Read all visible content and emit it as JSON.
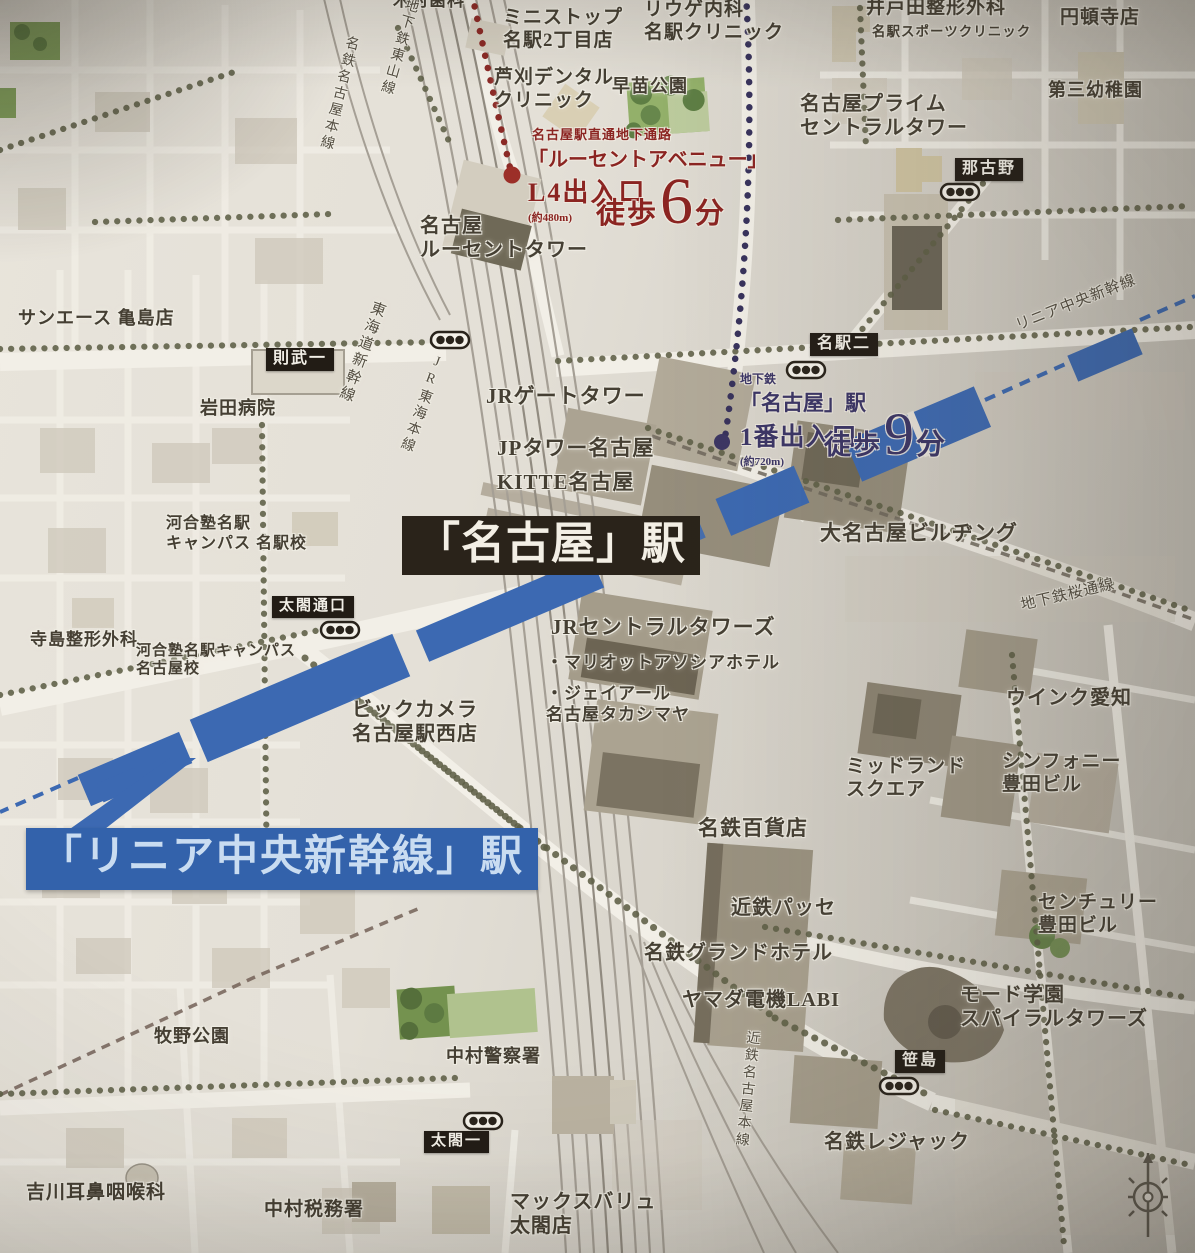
{
  "stations": {
    "nagoya": {
      "label": "「名古屋」駅"
    },
    "linear_chuo": {
      "label": "「リニア中央新幹線」駅"
    }
  },
  "walk_routes": [
    {
      "id": "lucent-avenue",
      "note": "名古屋駅直通地下通路",
      "destination_line1": "「ルーセントアベニュー」",
      "destination_line2": "L4出入口",
      "distance": "(約480m)",
      "walk_prefix": "徒歩",
      "minutes": "6",
      "unit": "分",
      "route_color": "#8b2421"
    },
    {
      "id": "subway-exit-1",
      "line_label": "地下鉄",
      "destination_line1": "「名古屋」駅",
      "destination_line2": "1番出入口",
      "distance": "(約720m)",
      "walk_prefix": "徒歩",
      "minutes": "9",
      "unit": "分",
      "route_color": "#3b3566"
    }
  ],
  "area_badges": [
    {
      "id": "noritake-1",
      "text": "則武一"
    },
    {
      "id": "meieki-2",
      "text": "名駅二"
    },
    {
      "id": "nagono",
      "text": "那古野"
    },
    {
      "id": "taiko-guchi",
      "text": "太閤通口"
    },
    {
      "id": "taiko-1",
      "text": "太閤一"
    },
    {
      "id": "sasashima",
      "text": "笹島"
    }
  ],
  "rail_lines": [
    {
      "id": "tokaido-shinkansen",
      "text": "東海道新幹線"
    },
    {
      "id": "jr-tokai-honsen",
      "text": "JR東海本線"
    },
    {
      "id": "meitetsu-nagoya-honsen",
      "text": "名鉄名古屋本線"
    },
    {
      "id": "subway-higashiyama",
      "text": "地下鉄東山線"
    },
    {
      "id": "subway-sakura-dori",
      "text": "地下鉄桜通線"
    },
    {
      "id": "kintetsu-nagoya-honsen",
      "text": "近鉄名古屋本線"
    },
    {
      "id": "linear-chuo-shinkansen",
      "text": "リニア中央新幹線"
    }
  ],
  "places": [
    {
      "id": "kimura-dental",
      "text": "木村歯科"
    },
    {
      "id": "ministop",
      "text": "ミニストップ\n名駅2丁目店"
    },
    {
      "id": "riuge-clinic",
      "text": "リウゲ内科\n名駅クリニック"
    },
    {
      "id": "itoda-seikei",
      "text": "井戸田整形外科"
    },
    {
      "id": "itoda-sub",
      "text": "名駅スポーツクリニック"
    },
    {
      "id": "endoji-store",
      "text": "円頓寺店"
    },
    {
      "id": "ashikari-dental",
      "text": "芦刈デンタル\nクリニック"
    },
    {
      "id": "sanae-park",
      "text": "早苗公園"
    },
    {
      "id": "nagoya-prime",
      "text": "名古屋プライム\nセントラルタワー"
    },
    {
      "id": "daisan-kindergarten",
      "text": "第三幼稚園"
    },
    {
      "id": "lucent-tower",
      "text": "名古屋\nルーセントタワー"
    },
    {
      "id": "sun-ace",
      "text": "サンエース 亀島店"
    },
    {
      "id": "iwata-hospital",
      "text": "岩田病院"
    },
    {
      "id": "kawai-meieki",
      "text": "河合塾名駅\nキャンパス 名駅校"
    },
    {
      "id": "jr-gate-tower",
      "text": "JRゲートタワー"
    },
    {
      "id": "jp-tower",
      "text": "JPタワー名古屋"
    },
    {
      "id": "kitte-nagoya",
      "text": "KITTE名古屋"
    },
    {
      "id": "dai-nagoya-bldg",
      "text": "大名古屋ビルヂング"
    },
    {
      "id": "terashima-seikei",
      "text": "寺島整形外科"
    },
    {
      "id": "kawai-nagoya",
      "text": "河合塾名駅キャンパス\n名古屋校"
    },
    {
      "id": "jr-central-towers",
      "text": "JRセントラルタワーズ"
    },
    {
      "id": "marriott-associa",
      "text": "・マリオットアソシアホテル"
    },
    {
      "id": "jr-takashimaya",
      "text": "・ジェイアール\n 名古屋タカシマヤ"
    },
    {
      "id": "bic-camera",
      "text": "ビックカメラ\n名古屋駅西店"
    },
    {
      "id": "wink-aichi",
      "text": "ウインク愛知"
    },
    {
      "id": "midland-square",
      "text": "ミッドランド\nスクエア"
    },
    {
      "id": "symphony-toyota",
      "text": "シンフォニー\n豊田ビル"
    },
    {
      "id": "meitetsu-dept",
      "text": "名鉄百貨店"
    },
    {
      "id": "kintetsu-passe",
      "text": "近鉄パッセ"
    },
    {
      "id": "meitetsu-grand",
      "text": "名鉄グランドホテル"
    },
    {
      "id": "yamada-labi",
      "text": "ヤマダ電機LABI"
    },
    {
      "id": "century-toyota",
      "text": "センチュリー\n豊田ビル"
    },
    {
      "id": "mode-gakuen",
      "text": "モード学園\nスパイラルタワーズ"
    },
    {
      "id": "meitetsu-lejac",
      "text": "名鉄レジャック"
    },
    {
      "id": "makino-park",
      "text": "牧野公園"
    },
    {
      "id": "nakamura-police",
      "text": "中村警察署"
    },
    {
      "id": "yoshikawa-ent",
      "text": "吉川耳鼻咽喉科"
    },
    {
      "id": "nakamura-tax",
      "text": "中村税務署"
    },
    {
      "id": "maxvalu-taiko",
      "text": "マックスバリュ\n太閤店"
    }
  ],
  "icons": {
    "traffic_signal": "traffic-signal-icon",
    "compass_rose": "compass-rose-icon"
  },
  "colors": {
    "walk_red": "#8b2421",
    "walk_navy": "#3b3566",
    "linear_blue": "#3c69b2",
    "station_box_bg": "#2a231a",
    "badge_bg": "#221c15",
    "banner_bg": "#3362ab"
  }
}
